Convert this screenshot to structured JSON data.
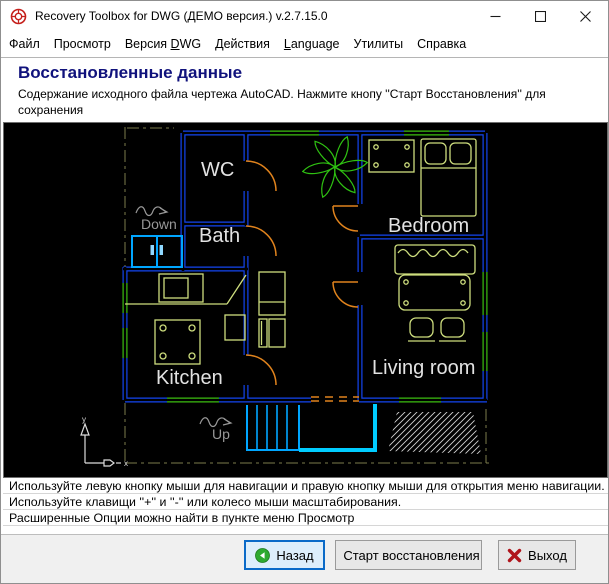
{
  "window": {
    "title": "Recovery Toolbox for DWG (ДЕМО версия.) v.2.7.15.0"
  },
  "menu": {
    "items": [
      {
        "pre": "Файл",
        "accel": "",
        "post": ""
      },
      {
        "pre": "Просмотр",
        "accel": "",
        "post": ""
      },
      {
        "pre": "Версия ",
        "accel": "D",
        "post": "WG"
      },
      {
        "pre": "Действия",
        "accel": "",
        "post": ""
      },
      {
        "pre": "",
        "accel": "L",
        "post": "anguage"
      },
      {
        "pre": "Утилиты",
        "accel": "",
        "post": ""
      },
      {
        "pre": "Справка",
        "accel": "",
        "post": ""
      }
    ]
  },
  "header": {
    "title": "Восстановленные данные",
    "desc1": "Содержание исходного файла чертежа AutoCAD. Нажмите кнопу ''Старт Восстановления'' для сохранения",
    "desc2": "результатов."
  },
  "plan": {
    "labels": {
      "wc": "WC",
      "bath": "Bath",
      "bedroom": "Bedroom",
      "kitchen": "Kitchen",
      "living": "Living room",
      "down": "Down",
      "up": "Up",
      "axis_x": "x",
      "axis_y": "y"
    }
  },
  "instructions": [
    "Используйте левую кнопку мыши для навигации и правую кнопку мыши для открытия меню навигации.",
    "Используйте клавищи ''+'' и ''-'' или колесо мыши масштабирования.",
    "Расширенные Опции можно найти в пункте меню Просмотр"
  ],
  "buttons": {
    "back": {
      "label": "Назад"
    },
    "start": {
      "label": "Старт восстановления"
    },
    "exit": {
      "label": "Выход"
    }
  },
  "colors": {
    "accent": "#0a6ac8",
    "navy": "#10127c",
    "wall": "#1345f0",
    "win-green": "#3cbe10",
    "door": "#e0831d",
    "furn": "#cede7e",
    "cyan": "#00a6ff",
    "cyan-bright": "#00ccff",
    "dashdot": "#7d7d4d",
    "label": "#e2e2e2",
    "anno": "#989898",
    "plant": "#2fc212",
    "back-green": "#2eaa30",
    "check-green": "#149414",
    "exit-red": "#b0151c",
    "hatch": "#d0d0d0"
  }
}
